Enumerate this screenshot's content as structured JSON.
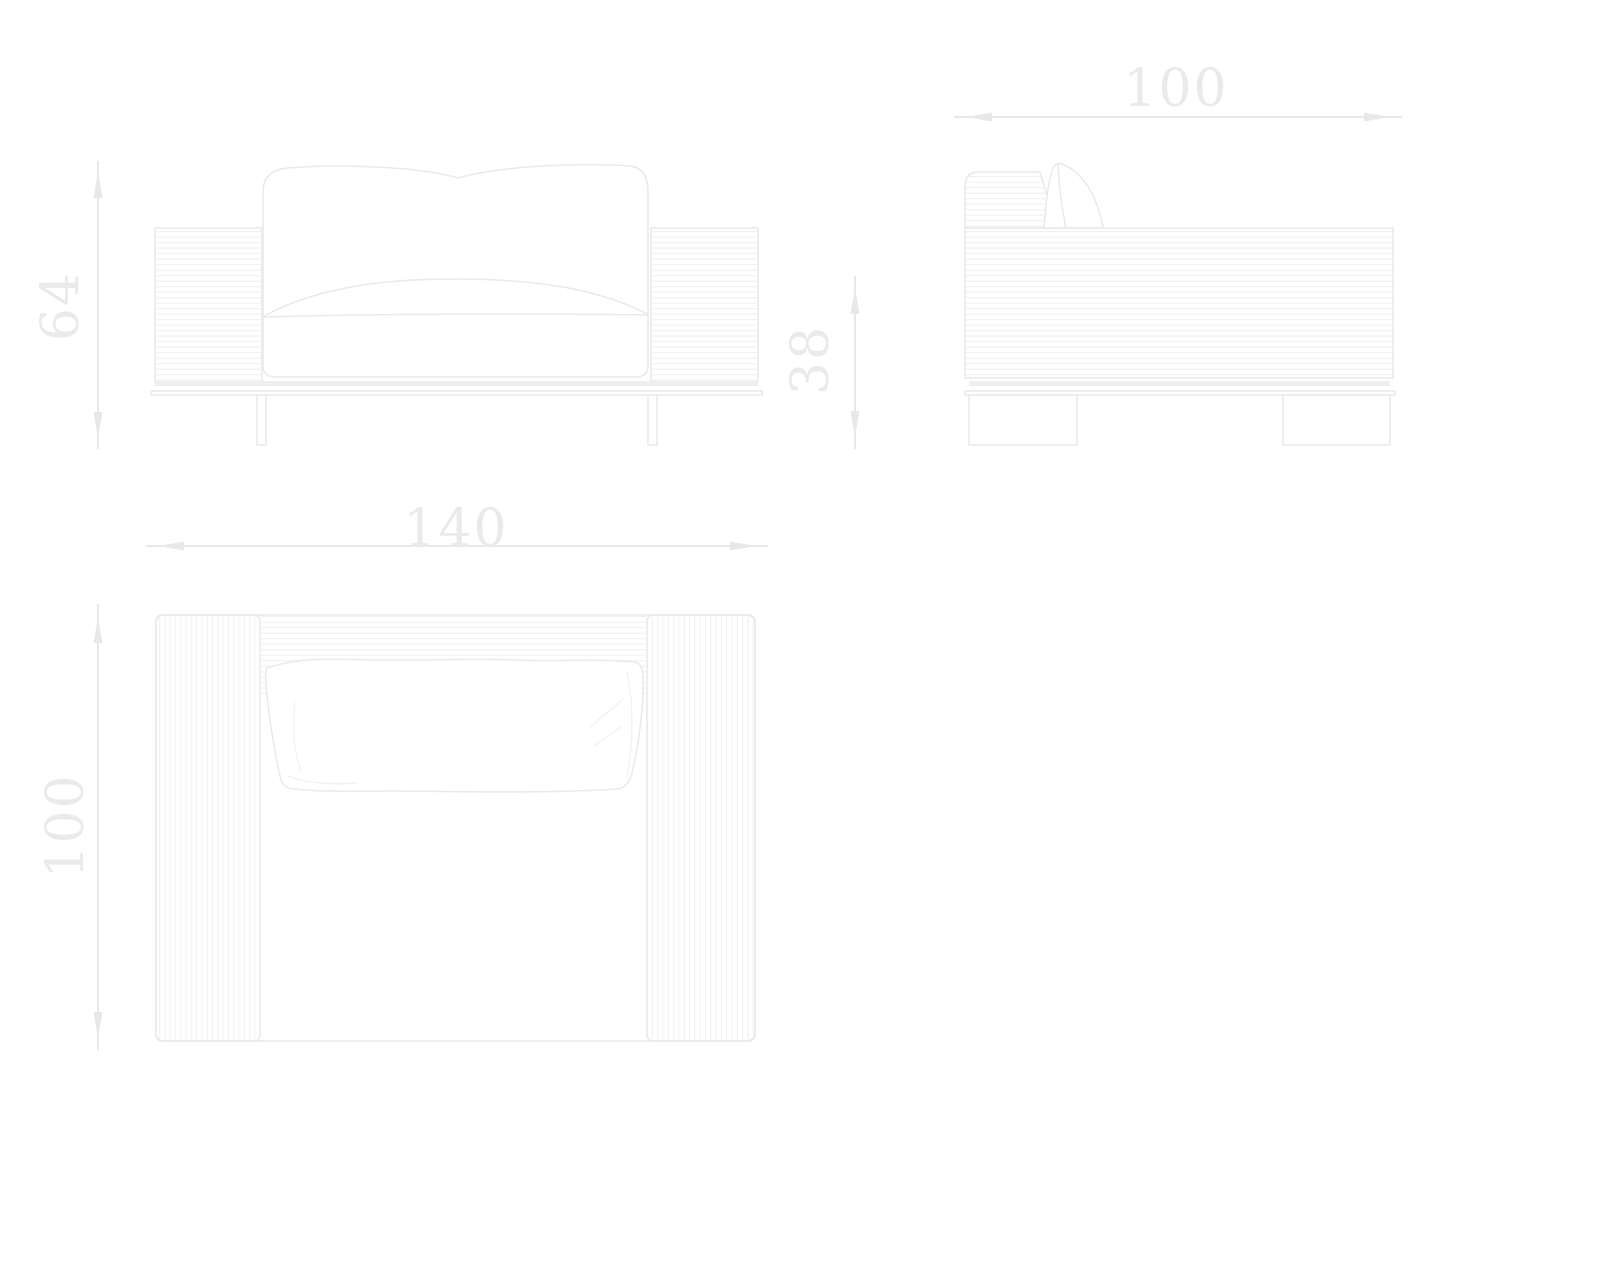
{
  "drawing": {
    "type": "furniture-technical-drawing",
    "subject": "armchair orthographic three-view drawing",
    "views": {
      "front": {
        "name": "front-elevation",
        "height_label": "64",
        "seat_height_label": "38"
      },
      "side": {
        "name": "side-elevation",
        "depth_label": "100"
      },
      "plan": {
        "name": "top-plan-view",
        "width_label": "140",
        "depth_label": "100"
      }
    },
    "colors": {
      "outline": "#e9e9e9",
      "slat": "#f2f2f2",
      "dimension": "#e8e8e8",
      "label_text": "#eaeaea",
      "base_band": "#efefef",
      "background": "#ffffff"
    }
  }
}
